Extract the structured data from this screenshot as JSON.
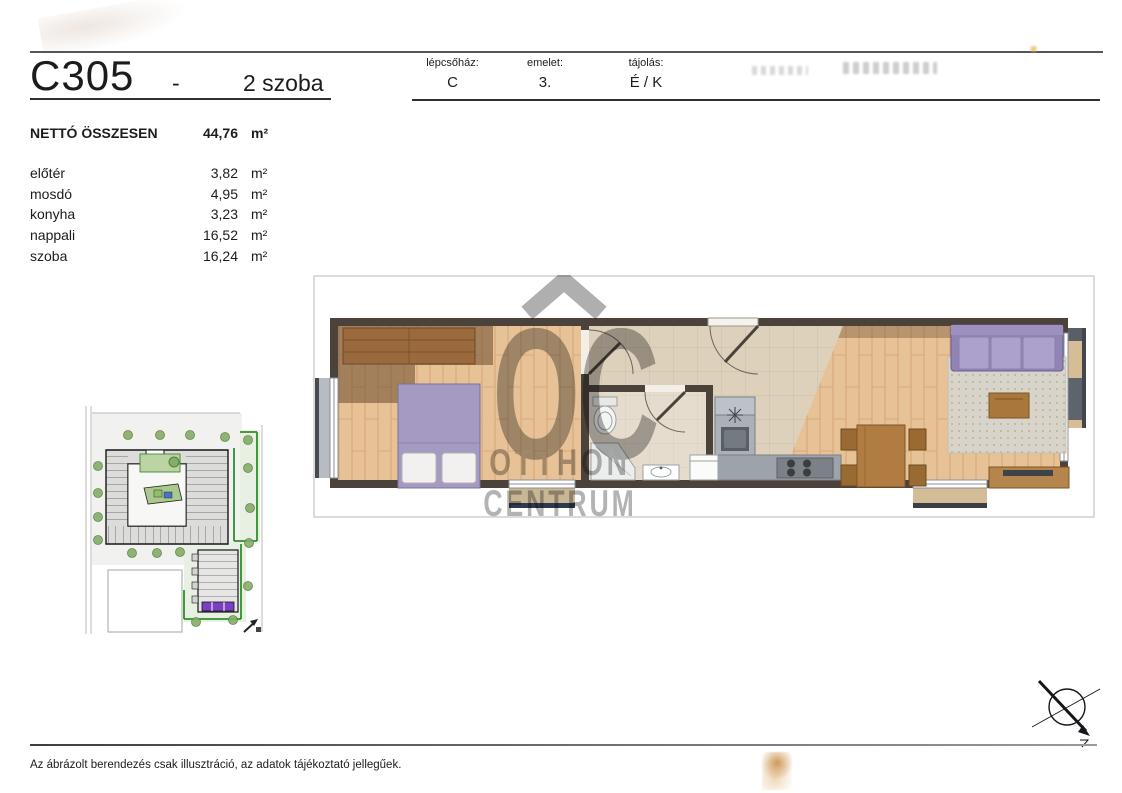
{
  "title": {
    "unit_id": "C305",
    "separator": "-",
    "room_count": "2 szoba"
  },
  "info_table": {
    "columns": [
      {
        "label": "lépcsőház:",
        "value": "C"
      },
      {
        "label": "emelet:",
        "value": "3."
      },
      {
        "label": "tájolás:",
        "value": "É / K"
      }
    ]
  },
  "areas": {
    "total": {
      "label": "NETTÓ ÖSSZESEN",
      "value": "44,76",
      "unit": "m²"
    },
    "rooms": [
      {
        "name": "előtér",
        "value": "3,82",
        "unit": "m²"
      },
      {
        "name": "mosdó",
        "value": "4,95",
        "unit": "m²"
      },
      {
        "name": "konyha",
        "value": "3,23",
        "unit": "m²"
      },
      {
        "name": "nappali",
        "value": "16,52",
        "unit": "m²"
      },
      {
        "name": "szoba",
        "value": "16,24",
        "unit": "m²"
      }
    ]
  },
  "watermark": {
    "monogram": "OC",
    "line1": "OTTHON",
    "line2": "CENTRUM"
  },
  "footer": {
    "disclaimer": "Az ábrázolt berendezés csak illusztráció, az adatok tájékoztató jellegűek."
  },
  "colors": {
    "unit_highlight_purple": "#7c3fc4",
    "furniture_purple": "#a59ac2",
    "site_boundary_green": "#2f9027",
    "watermark_gray": "#9b9b9b",
    "wall_dark": "#4a423b"
  }
}
